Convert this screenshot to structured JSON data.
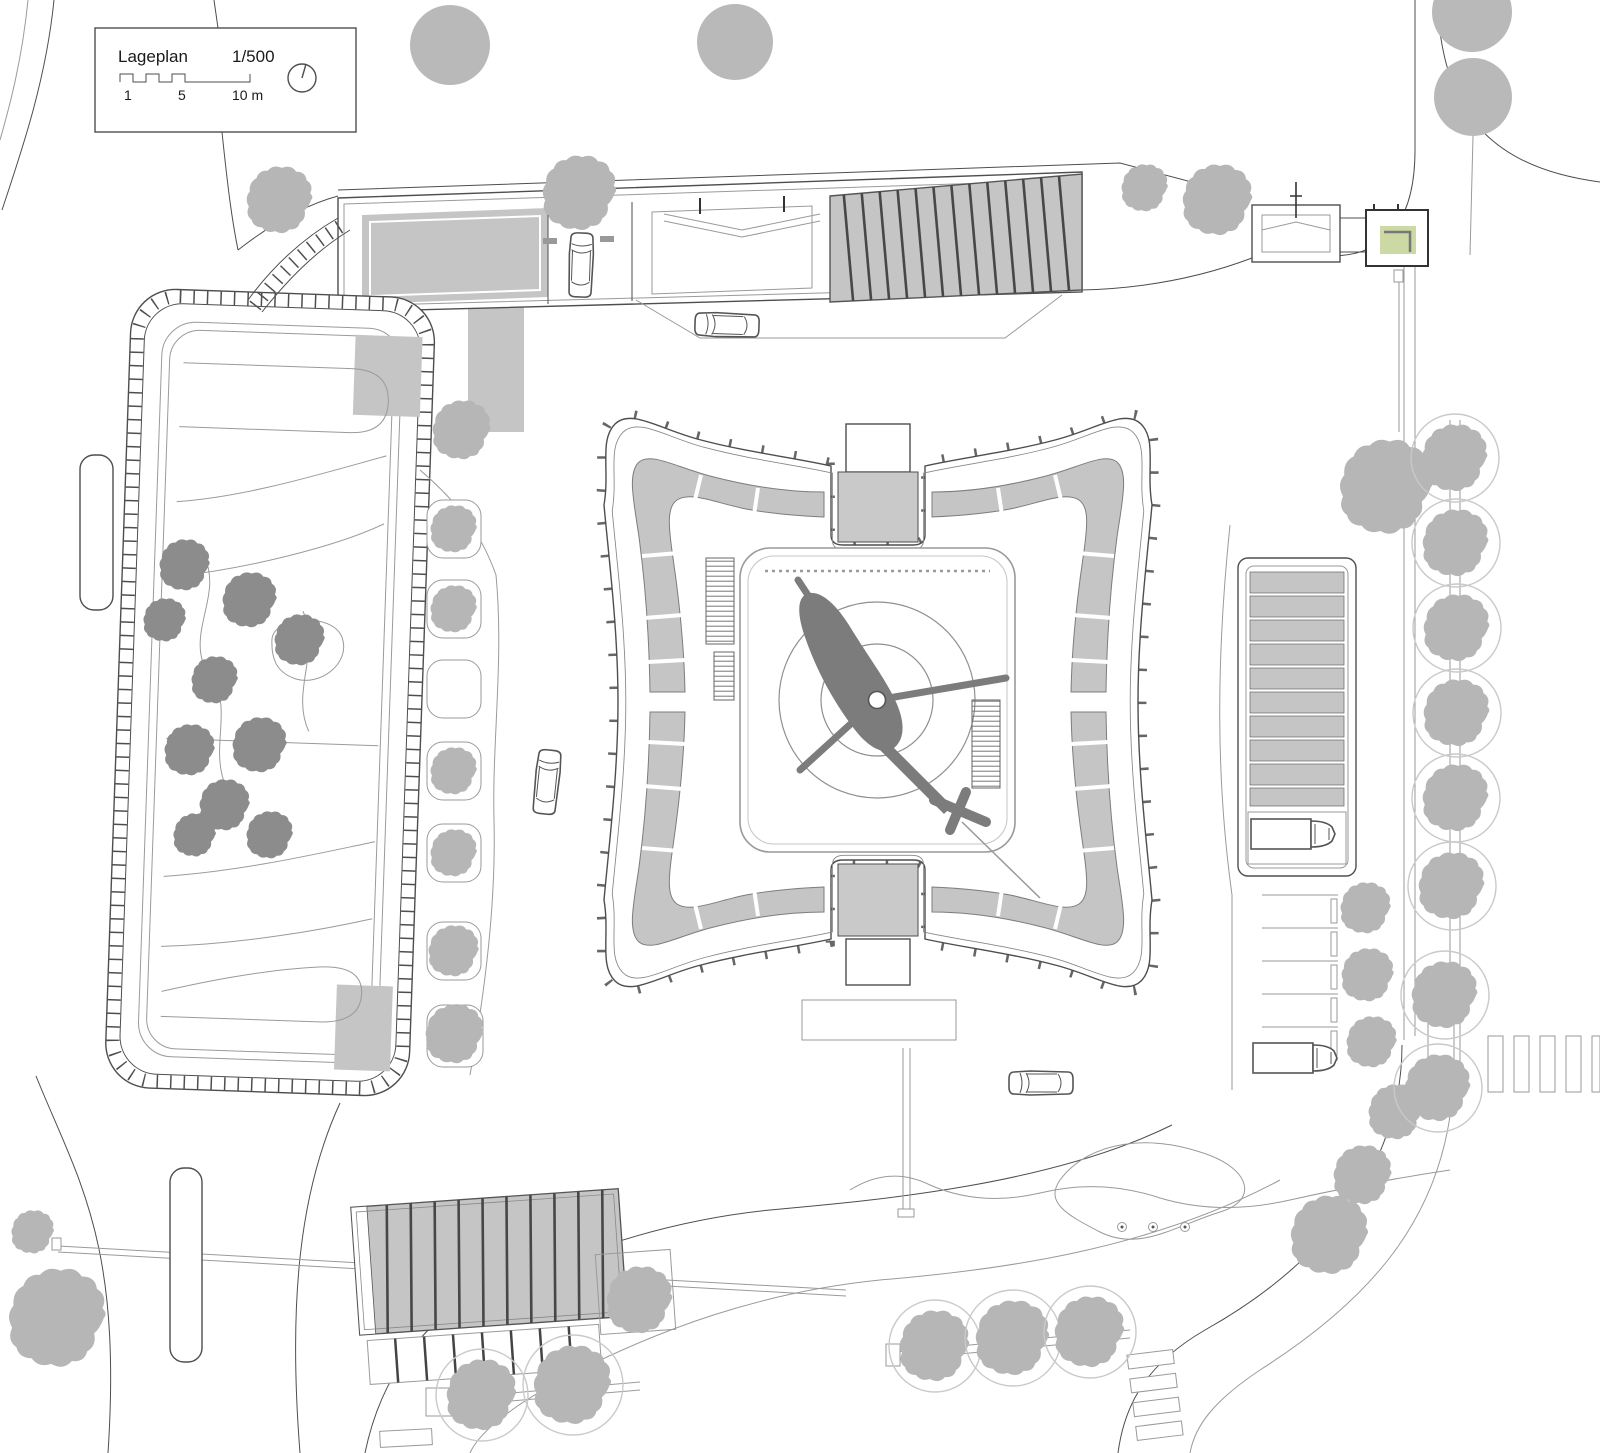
{
  "legend": {
    "title": "Lageplan",
    "scale": "1/500",
    "tick_1": "1",
    "tick_5": "5",
    "tick_10": "10 m"
  },
  "colors": {
    "line": "#4e4e4e",
    "lightline": "#9a9a9a",
    "ramp": "#c5c5c5",
    "core": "#c9c9c9",
    "treedark": "#8c8c8c",
    "treelight": "#b6b6b6",
    "treeplain": "#b9b9b9",
    "treecircle": "#c9c9c9",
    "heli": "#7c7c7c",
    "green": "#ccd9a4",
    "stripe": "#474747"
  },
  "icons": {
    "north_arrow": "compass-circle",
    "helicopter": "helicopter-silhouette",
    "tree": "canopy-blob",
    "car": "car-top-view",
    "truck": "truck-top-view",
    "crosswalk": "zebra-stripes",
    "stairs": "hatched-stair-run"
  },
  "trees": [
    {
      "x": 450,
      "y": 45,
      "r": 40,
      "kind": "plain"
    },
    {
      "x": 735,
      "y": 42,
      "r": 38,
      "kind": "plain"
    },
    {
      "x": 1472,
      "y": 12,
      "r": 40,
      "kind": "plain"
    },
    {
      "x": 1473,
      "y": 97,
      "r": 39,
      "kind": "plain"
    },
    {
      "x": 280,
      "y": 200,
      "r": 34,
      "kind": "light"
    },
    {
      "x": 580,
      "y": 193,
      "r": 38,
      "kind": "light"
    },
    {
      "x": 1145,
      "y": 188,
      "r": 24,
      "kind": "light"
    },
    {
      "x": 1218,
      "y": 200,
      "r": 36,
      "kind": "light"
    },
    {
      "x": 462,
      "y": 430,
      "r": 30,
      "kind": "light"
    },
    {
      "x": 1387,
      "y": 487,
      "r": 48,
      "kind": "light"
    },
    {
      "x": 1366,
      "y": 908,
      "r": 26,
      "kind": "light"
    },
    {
      "x": 1368,
      "y": 975,
      "r": 27,
      "kind": "light"
    },
    {
      "x": 1372,
      "y": 1042,
      "r": 26,
      "kind": "light"
    },
    {
      "x": 1396,
      "y": 1112,
      "r": 28,
      "kind": "light"
    },
    {
      "x": 1363,
      "y": 1175,
      "r": 30,
      "kind": "light"
    },
    {
      "x": 1330,
      "y": 1235,
      "r": 40,
      "kind": "light"
    },
    {
      "x": 640,
      "y": 1300,
      "r": 34,
      "kind": "light"
    },
    {
      "x": 58,
      "y": 1318,
      "r": 50,
      "kind": "light"
    },
    {
      "x": 33,
      "y": 1232,
      "r": 22,
      "kind": "light"
    },
    {
      "x": 1455,
      "y": 458,
      "r": 34,
      "kind": "circled"
    },
    {
      "x": 1456,
      "y": 543,
      "r": 34,
      "kind": "circled"
    },
    {
      "x": 1457,
      "y": 628,
      "r": 34,
      "kind": "circled"
    },
    {
      "x": 1457,
      "y": 713,
      "r": 34,
      "kind": "circled"
    },
    {
      "x": 1456,
      "y": 798,
      "r": 34,
      "kind": "circled"
    },
    {
      "x": 1452,
      "y": 886,
      "r": 34,
      "kind": "circled"
    },
    {
      "x": 1445,
      "y": 995,
      "r": 34,
      "kind": "circled"
    },
    {
      "x": 1438,
      "y": 1088,
      "r": 34,
      "kind": "circled"
    },
    {
      "x": 935,
      "y": 1346,
      "r": 36,
      "kind": "circled"
    },
    {
      "x": 1013,
      "y": 1338,
      "r": 38,
      "kind": "circled"
    },
    {
      "x": 1090,
      "y": 1332,
      "r": 36,
      "kind": "circled"
    },
    {
      "x": 482,
      "y": 1395,
      "r": 36,
      "kind": "circled"
    },
    {
      "x": 573,
      "y": 1385,
      "r": 40,
      "kind": "circled"
    },
    {
      "x": 185,
      "y": 565,
      "r": 26,
      "kind": "dark"
    },
    {
      "x": 165,
      "y": 620,
      "r": 22,
      "kind": "dark"
    },
    {
      "x": 250,
      "y": 600,
      "r": 28,
      "kind": "dark"
    },
    {
      "x": 215,
      "y": 680,
      "r": 24,
      "kind": "dark"
    },
    {
      "x": 190,
      "y": 750,
      "r": 26,
      "kind": "dark"
    },
    {
      "x": 260,
      "y": 745,
      "r": 28,
      "kind": "dark"
    },
    {
      "x": 225,
      "y": 805,
      "r": 26,
      "kind": "dark"
    },
    {
      "x": 270,
      "y": 835,
      "r": 24,
      "kind": "dark"
    },
    {
      "x": 195,
      "y": 835,
      "r": 22,
      "kind": "dark"
    },
    {
      "x": 300,
      "y": 640,
      "r": 26,
      "kind": "dark"
    },
    {
      "x": 454,
      "y": 529,
      "r": 24,
      "kind": "light"
    },
    {
      "x": 454,
      "y": 609,
      "r": 24,
      "kind": "light"
    },
    {
      "x": 454,
      "y": 771,
      "r": 24,
      "kind": "light"
    },
    {
      "x": 454,
      "y": 853,
      "r": 24,
      "kind": "light"
    },
    {
      "x": 454,
      "y": 951,
      "r": 26,
      "kind": "light"
    },
    {
      "x": 455,
      "y": 1034,
      "r": 30,
      "kind": "light"
    }
  ],
  "cars": [
    {
      "x": 581,
      "y": 265,
      "rot": 2
    },
    {
      "x": 727,
      "y": 325,
      "rot": -88
    },
    {
      "x": 547,
      "y": 782,
      "rot": 6
    },
    {
      "x": 1041,
      "y": 1083,
      "rot": -90
    }
  ],
  "trucks": [
    {
      "x": 1295,
      "y": 834,
      "rot": 0
    },
    {
      "x": 1297,
      "y": 1058,
      "rot": 0
    }
  ]
}
